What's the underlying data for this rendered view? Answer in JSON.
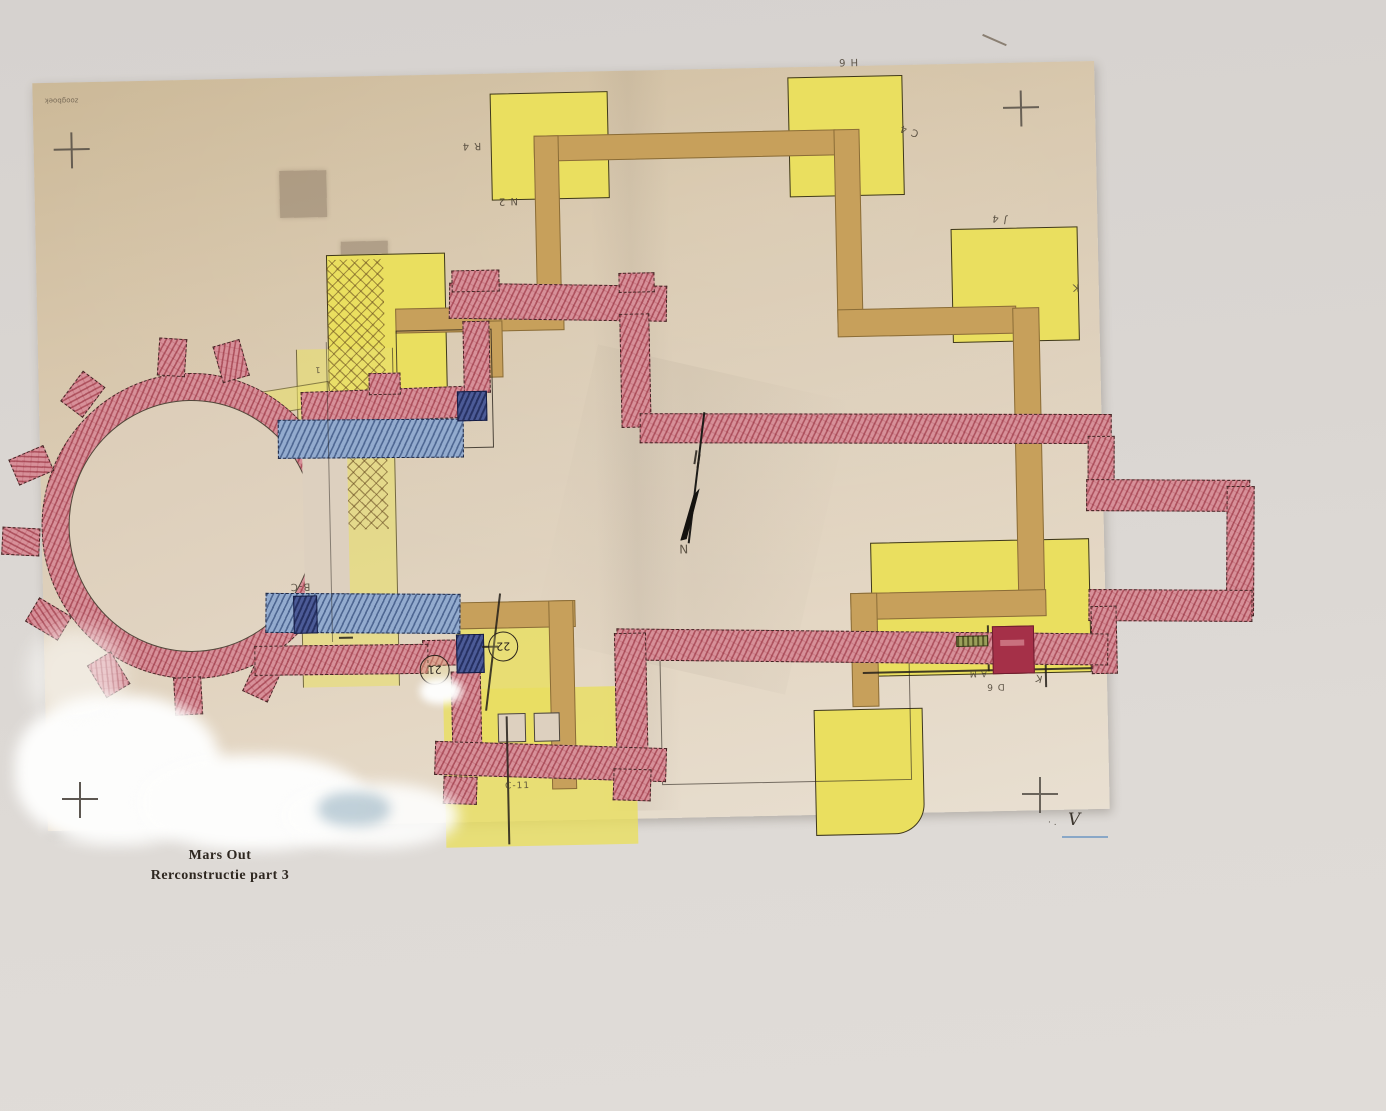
{
  "document": {
    "type": "scanned architectural reconstruction plan (church floor plan) on aged paper",
    "caption": {
      "line1": "Mars Out",
      "line2": "Rerconstructie part 3"
    },
    "corner_note": "zoogboek",
    "north_indicator": {
      "letter": "N"
    },
    "circled_numbers": {
      "n21": "21",
      "n22": "22"
    },
    "labels": [
      {
        "id": "grid-r4",
        "text": "R 4"
      },
      {
        "id": "grid-n2",
        "text": "N 2"
      },
      {
        "id": "grid-h6",
        "text": "H 6"
      },
      {
        "id": "grid-c4",
        "text": "C 4"
      },
      {
        "id": "grid-j4",
        "text": "J 4"
      },
      {
        "id": "grid-k",
        "text": "K"
      },
      {
        "id": "mark-1",
        "text": "1"
      },
      {
        "id": "grid-bc",
        "text": "B-C"
      },
      {
        "id": "grid-am",
        "text": "A M"
      },
      {
        "id": "grid-d6",
        "text": "D 6"
      },
      {
        "id": "grid-k2",
        "text": "K"
      },
      {
        "id": "grid-c11",
        "text": "C-11"
      },
      {
        "id": "mark-v",
        "text": "V"
      }
    ],
    "colors": {
      "paper": "#d9c8ae",
      "background": "#dad6d2",
      "yellow_rooms": "#eadf5f",
      "tan_walls": "#c7a05b",
      "red_hatched_walls": "#d79099",
      "blue_hatched_bands": "#93abce",
      "dark_blue_blocks": "#4c5b97",
      "solid_red_block": "#a53048"
    },
    "registration_marks": 4
  }
}
